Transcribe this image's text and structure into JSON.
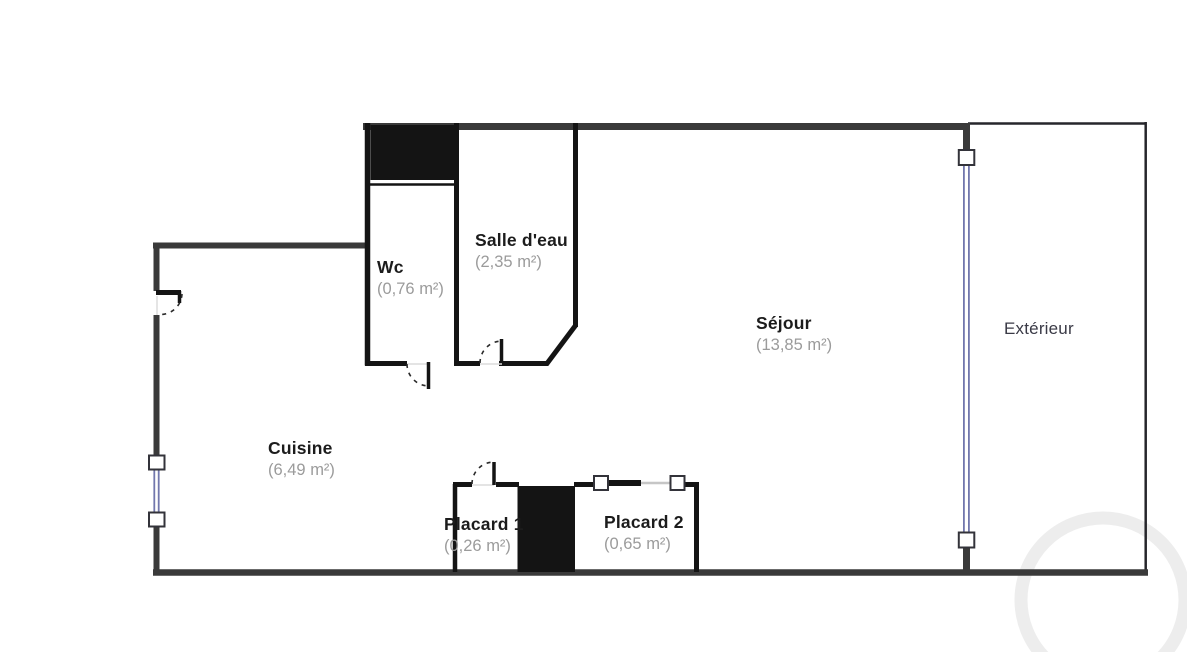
{
  "plan_title": "Appartement - plan d'étage",
  "rooms": [
    {
      "id": "wc",
      "name": "Wc",
      "area": "(0,76 m²)"
    },
    {
      "id": "salle-deau",
      "name": "Salle d'eau",
      "area": "(2,35 m²)"
    },
    {
      "id": "sejour",
      "name": "Séjour",
      "area": "(13,85 m²)"
    },
    {
      "id": "cuisine",
      "name": "Cuisine",
      "area": "(6,49 m²)"
    },
    {
      "id": "placard-1",
      "name": "Placard 1",
      "area": "(0,26 m²)"
    },
    {
      "id": "placard-2",
      "name": "Placard 2",
      "area": "(0,65 m²)"
    },
    {
      "id": "exterieur",
      "name": "Extérieur",
      "area": ""
    }
  ],
  "colors": {
    "wall_outer": "#3a3a3a",
    "wall_inner": "#141414",
    "exterior_outline": "#26262b",
    "window_blue": "#7277ad",
    "room_name": "#1c1c1c",
    "room_area": "#9b9b9b",
    "exterior_label": "#3a3a46",
    "watermark": "#ededed"
  }
}
